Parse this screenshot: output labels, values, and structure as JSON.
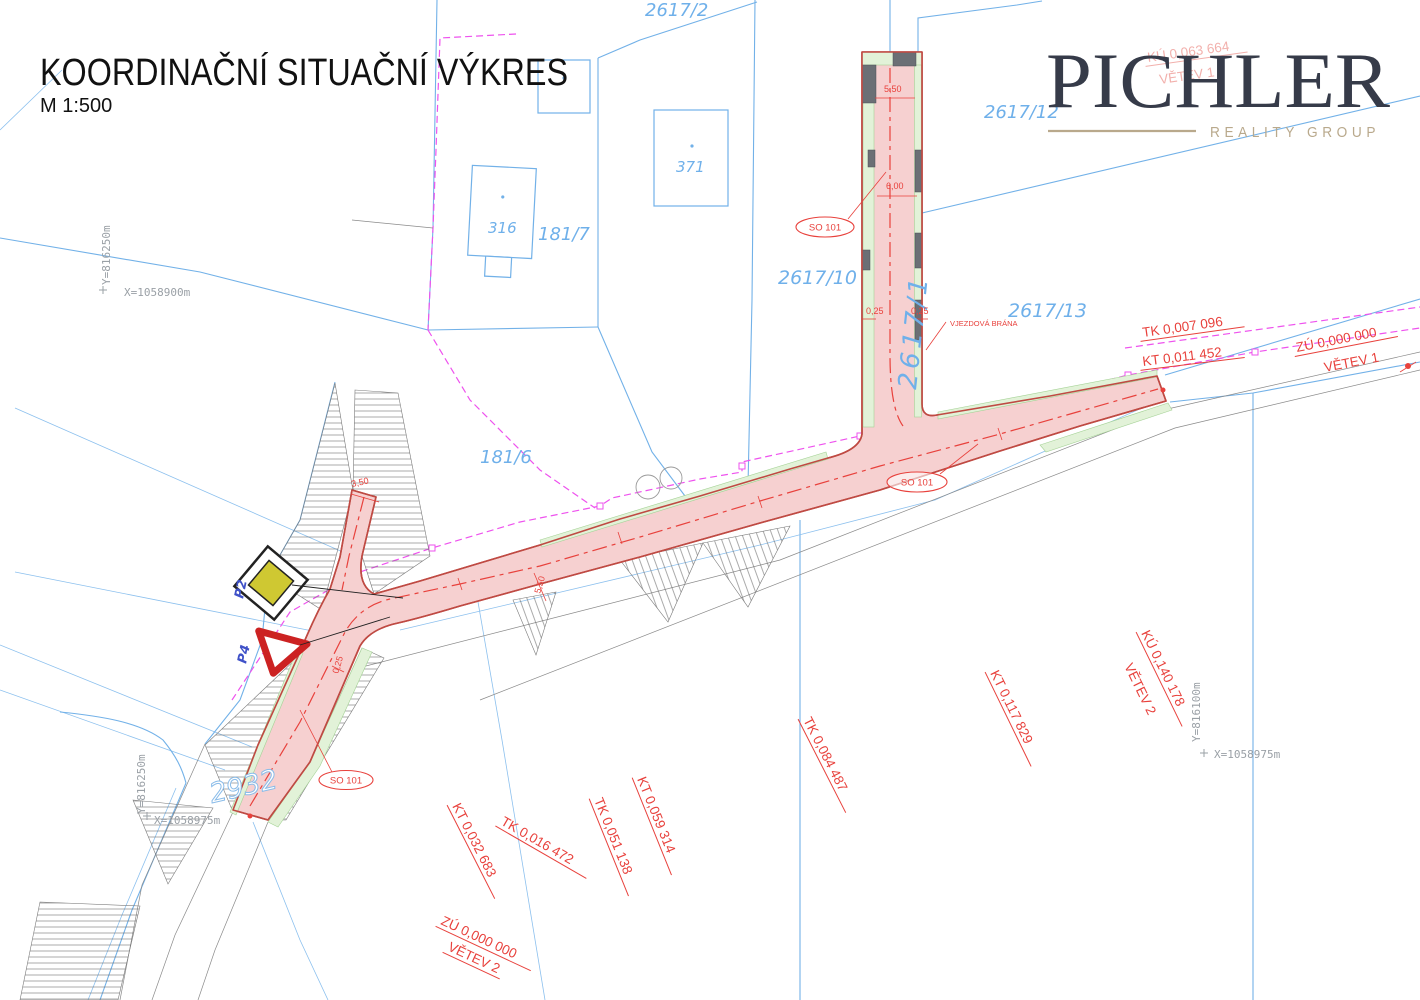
{
  "title": {
    "main": "KOORDINAČNÍ SITUAČNÍ VÝKRES",
    "scale": "M 1:500"
  },
  "logo": {
    "brand": "PICHLER",
    "tagline": "REALITY GROUP"
  },
  "callouts": {
    "so101": "SO 101",
    "gate": "VJEZDOVÁ BRÁNA"
  },
  "traffic_signs": {
    "p2": "P2",
    "p4": "P4"
  },
  "slope_labels": [
    {
      "text": "TK 0,007 096"
    },
    {
      "text": "KT 0,011 452"
    },
    {
      "text": "ZÚ 0,000 000"
    },
    {
      "text": "VĚTEV 1"
    },
    {
      "text": "KÚ 0,063 664"
    },
    {
      "text": "VĚTEV 1"
    },
    {
      "text": "TK 0,084 487"
    },
    {
      "text": "KT 0,117 829"
    },
    {
      "text": "KÚ 0,140 178"
    },
    {
      "text": "VĚTEV 2"
    },
    {
      "text": "KT 0,032 683"
    },
    {
      "text": "TK 0,016 472"
    },
    {
      "text": "TK 0,051 138"
    },
    {
      "text": "KT 0,059 314"
    },
    {
      "text": "ZÚ 0,000 000"
    },
    {
      "text": "VĚTEV 2"
    }
  ],
  "parcel_labels": [
    {
      "text": "2617/2"
    },
    {
      "text": "2617/12"
    },
    {
      "text": "2617/10"
    },
    {
      "text": "2617/13"
    },
    {
      "text": "2617/1"
    },
    {
      "text": "181/7"
    },
    {
      "text": "181/6"
    },
    {
      "text": "371"
    },
    {
      "text": "316"
    },
    {
      "text": "2932"
    }
  ],
  "coordinate_labels": [
    {
      "text": "Y=816250m"
    },
    {
      "text": "X=1058900m"
    },
    {
      "text": "Y=816250m"
    },
    {
      "text": "X=1058975m"
    },
    {
      "text": "Y=816100m"
    },
    {
      "text": "X=1058975m"
    }
  ],
  "dimension_labels": [
    {
      "text": "5,50"
    },
    {
      "text": "6,00"
    },
    {
      "text": "0,25"
    },
    {
      "text": "0,25"
    },
    {
      "text": "3,50"
    },
    {
      "text": "5,50"
    },
    {
      "text": "0,25"
    }
  ],
  "colors": {
    "road_fill": "#f6d0d0",
    "road_edge": "#bf4a43",
    "centerline_red": "#e8413c",
    "parcel_blue": "#72b1e8",
    "utility_magenta": "#ee52ee",
    "verge_green": "#e2f2d8",
    "label_gray": "#9aa0a6",
    "sign_yellow": "#cfc832",
    "logo_dark": "#363b49",
    "logo_tan": "#b9a98c"
  }
}
